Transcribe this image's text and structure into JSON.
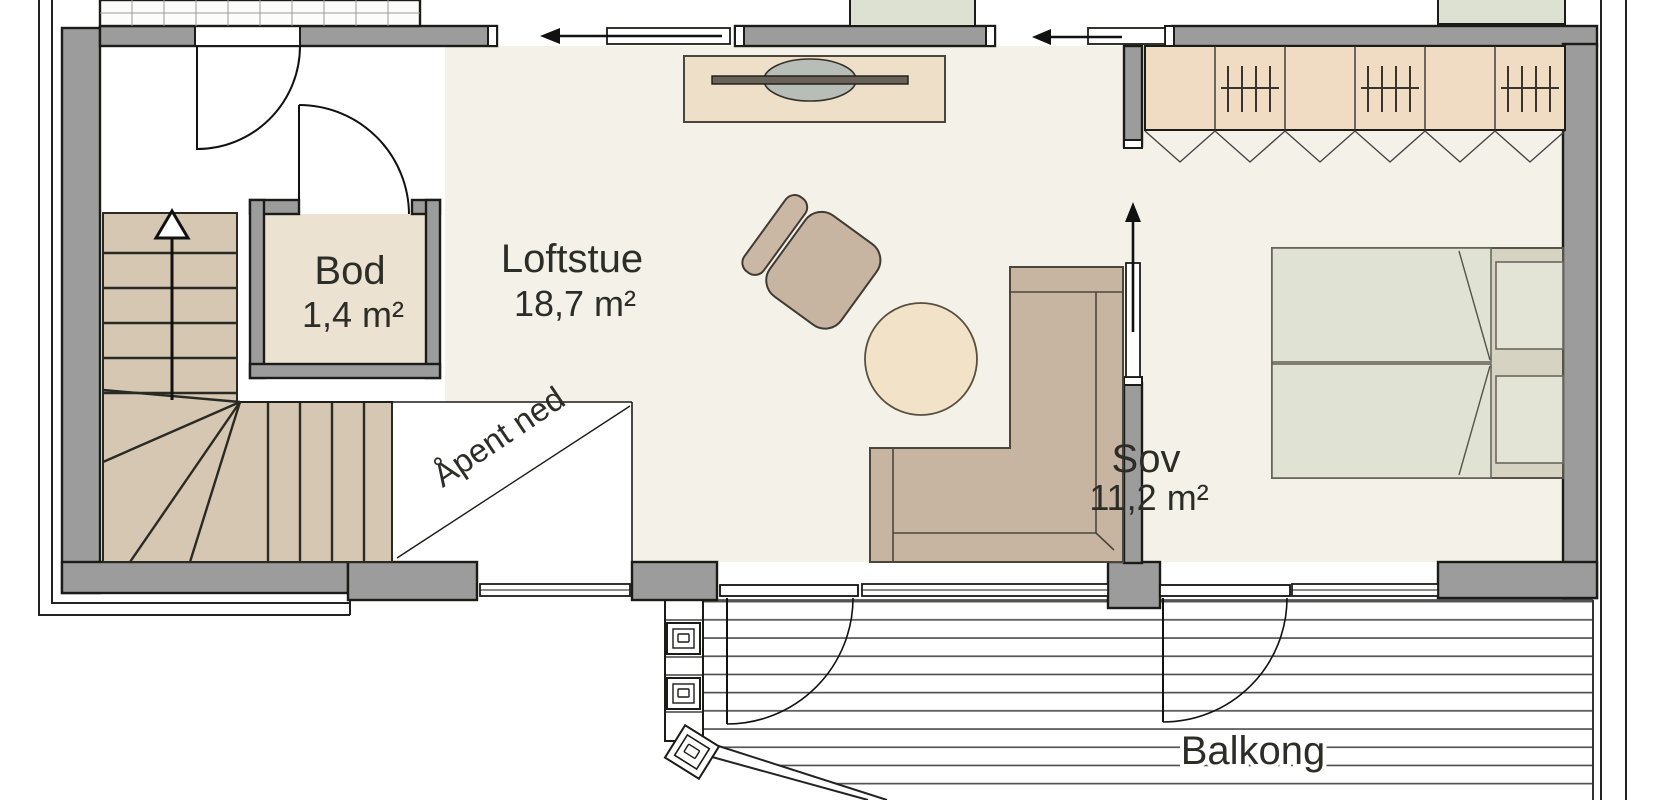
{
  "rooms": [
    {
      "id": "bod",
      "name": "Bod",
      "area": "1,4 m²"
    },
    {
      "id": "loftstue",
      "name": "Loftstue",
      "area": "18,7 m²"
    },
    {
      "id": "sov",
      "name": "Sov",
      "area": "11,2 m²"
    },
    {
      "id": "balkong",
      "name": "Balkong",
      "area": ""
    }
  ],
  "annotations": {
    "open_below": "Åpent ned",
    "stair_direction": "up"
  },
  "icons": [
    "stairs-up-arrow-icon",
    "sliding-door-arrow-icon",
    "door-swing-icon",
    "wardrobe-rail-icon",
    "tv-sideboard-icon",
    "armchair-icon",
    "round-table-icon",
    "corner-sofa-icon",
    "double-bed-icon",
    "balcony-post-icon",
    "deck-boards-icon",
    "window-icon"
  ],
  "colors": {
    "wall": "#9c9c9c",
    "wall_outline": "#1b1b18",
    "floor": "#f4f1e9",
    "void_floor": "#ffffff",
    "stairs": "#d5c7b1",
    "bod_floor": "#ece2d2",
    "wardrobe": "#efdcc3",
    "sofa": "#c8b5a1",
    "table": "#f2e2c8",
    "bed_linen": "#e0e2d3",
    "bed_frame": "#d7d3c3",
    "cabinet": "#dde1d2",
    "tv": "#5a5550",
    "deck_line": "#4a4a4a"
  }
}
